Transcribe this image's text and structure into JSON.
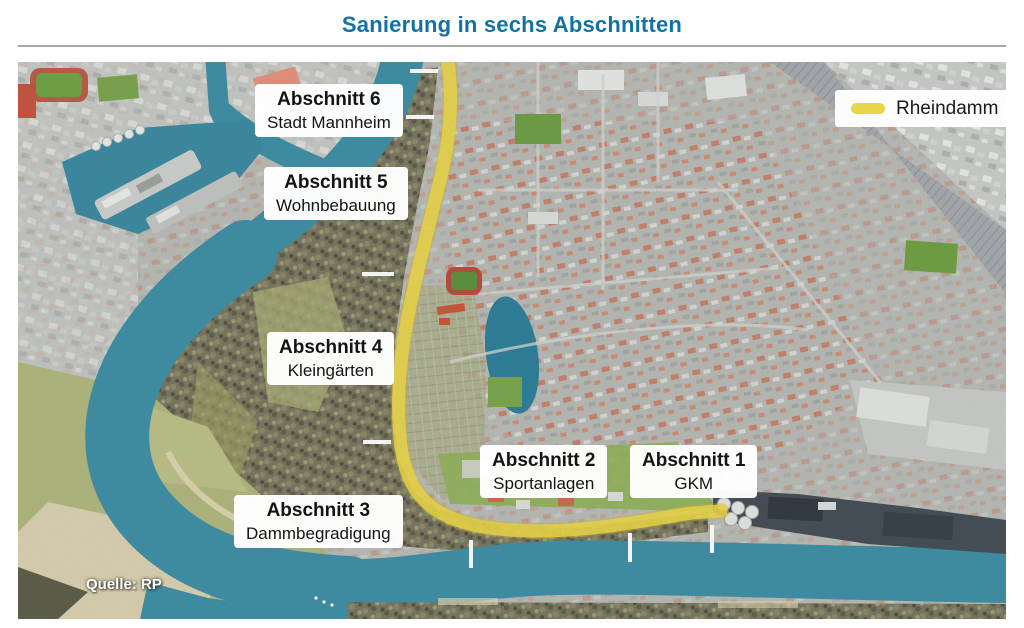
{
  "header": {
    "title": "Sanierung in sechs Abschnitten"
  },
  "map": {
    "legend": {
      "label": "Rheindamm",
      "swatch_color": "#e9d54a"
    },
    "source": "Quelle: RP",
    "sections": [
      {
        "id": 1,
        "title": "Abschnitt 1",
        "subtitle": "GKM"
      },
      {
        "id": 2,
        "title": "Abschnitt 2",
        "subtitle": "Sportanlagen"
      },
      {
        "id": 3,
        "title": "Abschnitt 3",
        "subtitle": "Dammbegradigung"
      },
      {
        "id": 4,
        "title": "Abschnitt 4",
        "subtitle": "Kleingärten"
      },
      {
        "id": 5,
        "title": "Abschnitt 5",
        "subtitle": "Wohnbebauung"
      },
      {
        "id": 6,
        "title": "Abschnitt 6",
        "subtitle": "Stadt Mannheim"
      }
    ],
    "colors": {
      "title_accent": "#1173a3",
      "rheindamm_yellow": "#e9d54a",
      "water_teal": "#3f8da3",
      "forest_olive": "#787660",
      "city_gray": "#b6b8b4"
    }
  }
}
